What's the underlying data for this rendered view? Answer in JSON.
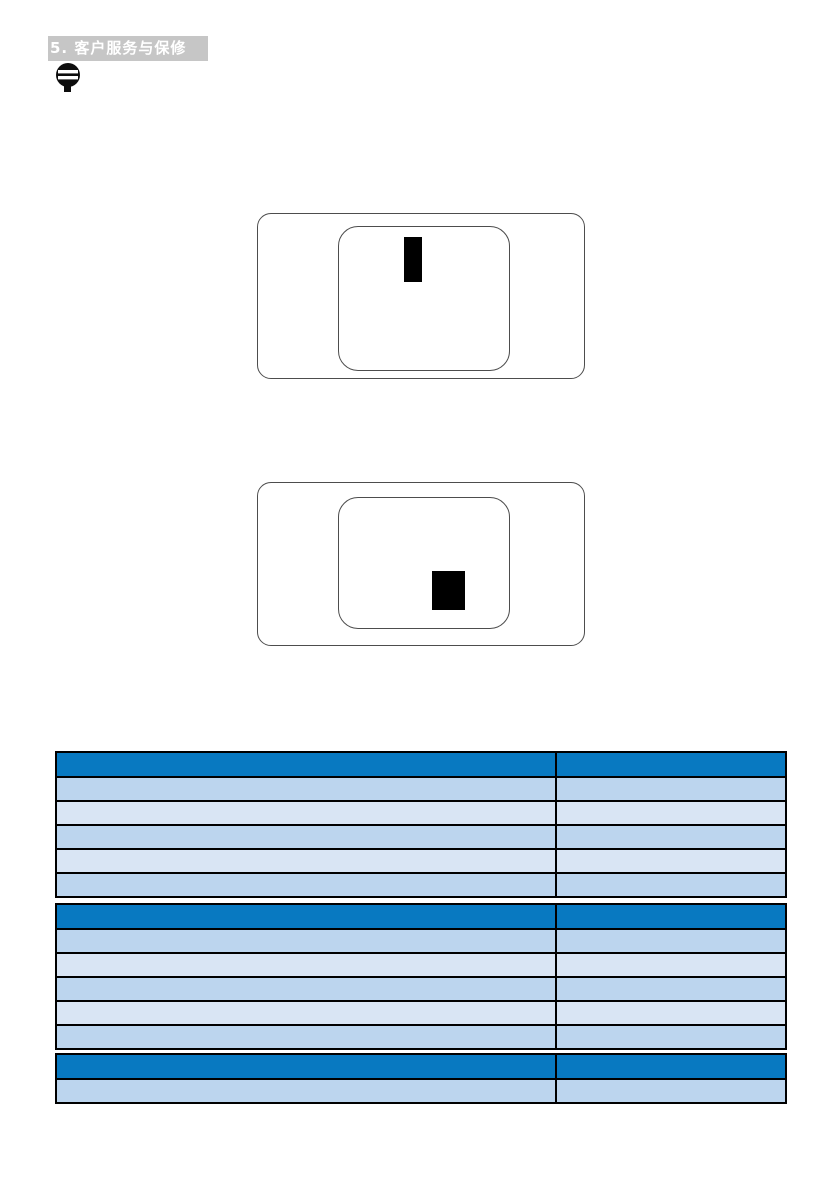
{
  "header": {
    "section_title": "5. 客户服务与保修"
  },
  "icons": {
    "note_icon": "filled-circle-with-text-lines"
  },
  "colors": {
    "title_bar_bg": "#c6c6c6",
    "title_bar_text": "#ffffff",
    "table_header_bg": "#0879c1",
    "row_shade_dark": "#bcd5ee",
    "row_shade_light": "#d9e5f4",
    "table_border": "#000000",
    "diagram_outline": "#4d4d4d",
    "defect_mark": "#000000"
  },
  "diagrams": [
    {
      "name": "pixel-defect-example-top",
      "mark_shape": "tall-rectangle-near-top-center"
    },
    {
      "name": "pixel-defect-example-bottom",
      "mark_shape": "square-block-lower-right"
    }
  ],
  "tables": [
    {
      "name": "defect-table-1",
      "header": [
        "",
        ""
      ],
      "rows": [
        [
          "",
          ""
        ],
        [
          "",
          ""
        ],
        [
          "",
          ""
        ],
        [
          "",
          ""
        ],
        [
          "",
          ""
        ]
      ]
    },
    {
      "name": "defect-table-2",
      "header": [
        "",
        ""
      ],
      "rows": [
        [
          "",
          ""
        ],
        [
          "",
          ""
        ],
        [
          "",
          ""
        ],
        [
          "",
          ""
        ],
        [
          "",
          ""
        ]
      ]
    },
    {
      "name": "defect-table-3",
      "header": [
        "",
        ""
      ],
      "rows": [
        [
          "",
          ""
        ]
      ]
    }
  ]
}
